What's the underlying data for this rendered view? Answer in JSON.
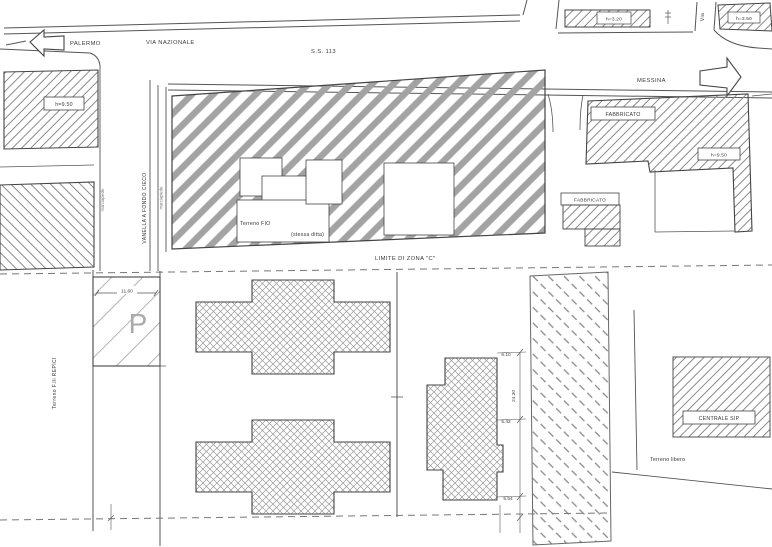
{
  "drawing": {
    "type": "site-plan",
    "colors": {
      "line": "#444444",
      "hatch_gray": "#a3a3a3",
      "fine_hatch": "#8a8a8a",
      "dash_line": "#777777",
      "text": "#3a3a3a"
    },
    "roads": {
      "palermo_label": "PALERMO",
      "via_nazionale_label": "VIA NAZIONALE",
      "ss113_label": "S.S. 113",
      "messina_label": "MESSINA",
      "via_label": "Via",
      "vanella_label": "VANELLA A FONDO CIECO",
      "sidewalk_west_label": "marciapiede",
      "sidewalk_east_label": "marciapiede"
    },
    "zone": {
      "limite_label": "LIMITE DI ZONA \"C\""
    },
    "buildings": {
      "left_building_height": "h=9.50",
      "north_strip_height": "h=3.20",
      "corner_strip_height": "h=3.50",
      "terreno_fio_label": "Terreno FIO",
      "stessa_ditta_label": "(stessa ditta)",
      "fabbricato_1_label": "FABBRICATO",
      "fabbricato_2_label": "FABBRICATO",
      "right_building_height": "h=9.50",
      "centrale_sip_label": "CENTRALE SIP"
    },
    "parcels": {
      "terreno_repici_label": "Terreno F.lli REPICI",
      "terreno_libero_label": "Terreno libero",
      "parking_letter": "P"
    },
    "dimensions": {
      "parking_width": "11.60",
      "dim_top": "6.10",
      "dim_side": "24.30",
      "dim_mid": "5.42",
      "dim_bottom": "5.54"
    }
  }
}
